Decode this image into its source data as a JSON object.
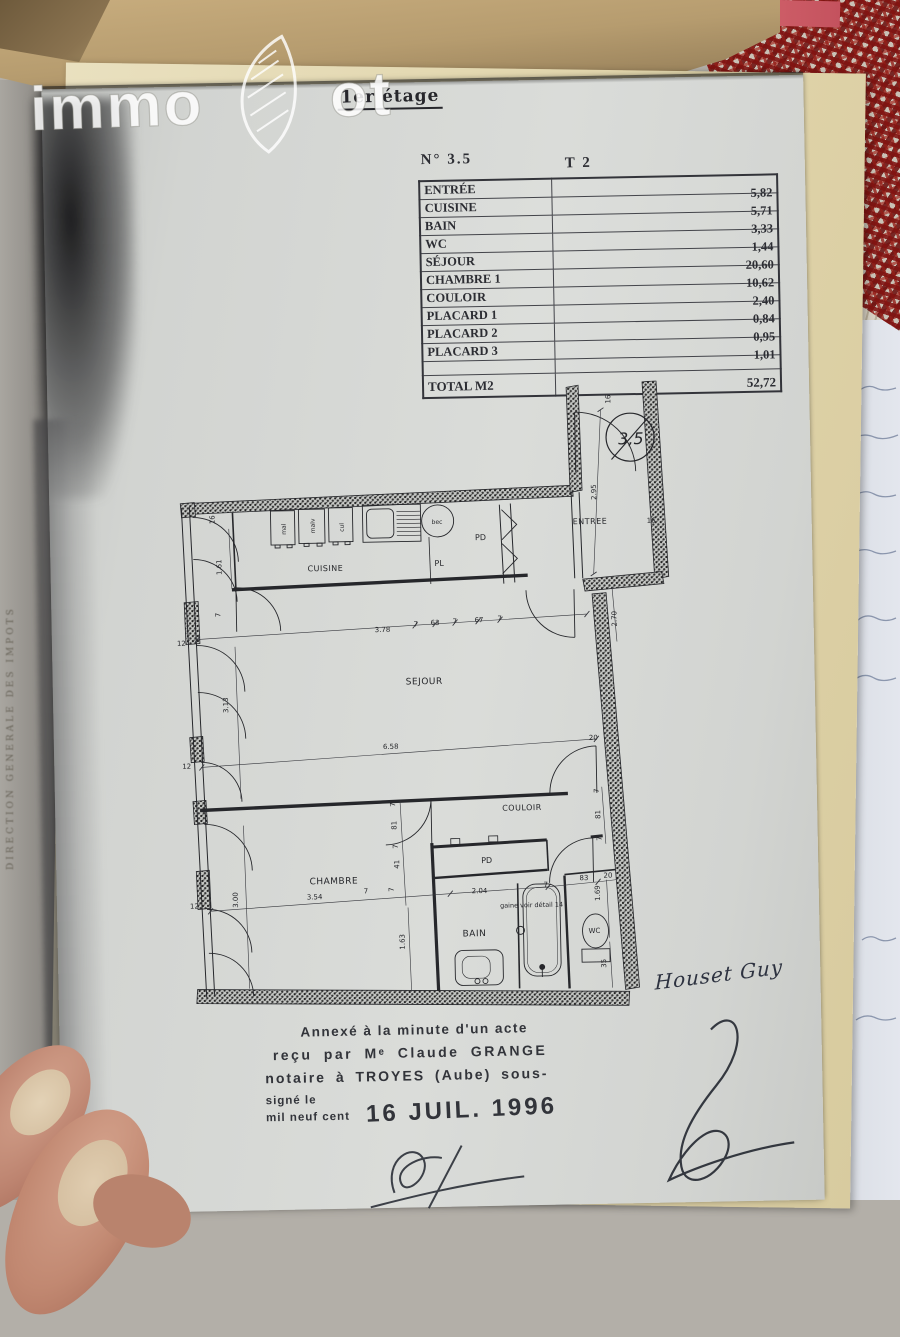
{
  "photo": {
    "watermark": {
      "part1": "immo",
      "part2": "ot"
    },
    "letterhead": "CLAUDE GRAN",
    "spine_text": "DIRECTION GENERALE DES IMPOTS"
  },
  "page": {
    "title": "1er étage",
    "doc_number": "N°  3.5",
    "type_label": "T 2",
    "table": {
      "rows": [
        {
          "label": "ENTRÉE",
          "value": "5,82"
        },
        {
          "label": "CUISINE",
          "value": "5,71"
        },
        {
          "label": "BAIN",
          "value": "3,33"
        },
        {
          "label": "WC",
          "value": "1,44"
        },
        {
          "label": "SÉJOUR",
          "value": "20,60"
        },
        {
          "label": "CHAMBRE 1",
          "value": "10,62"
        },
        {
          "label": "COULOIR",
          "value": "2,40"
        },
        {
          "label": "PLACARD 1",
          "value": "0,84"
        },
        {
          "label": "PLACARD 2",
          "value": "0,95"
        },
        {
          "label": "PLACARD 3",
          "value": "1,01"
        }
      ],
      "total_label": "TOTAL M2",
      "total_value": "52,72"
    },
    "annotation": {
      "line1": "Annexé à la minute d'un acte",
      "line2": "reçu par Mᵉ Claude GRANGE",
      "line3": "notaire à TROYES (Aube) sous-",
      "line4a": "signé le",
      "line4b": "mil neuf cent",
      "date_stamp": "16 JUIL. 1996"
    },
    "signature_name": "Houset Guy"
  },
  "plan": {
    "unit_circle": "3,5",
    "rooms": {
      "entree": "ENTREE",
      "cuisine": "CUISINE",
      "pl": "PL",
      "pd_kitchen": "PD",
      "sejour": "SEJOUR",
      "couloir": "COULOIR",
      "pd_couloir": "PD",
      "chambre": "CHAMBRE",
      "bain": "BAIN",
      "wc": "WC"
    },
    "fixtures": {
      "f1": "mal",
      "f2": "malv",
      "f3": "cul",
      "f4": "bec"
    },
    "note": "gaine voir détail 14",
    "dims": [
      "16",
      "2.95",
      "16",
      "2.70",
      "16",
      "1.61",
      "7",
      "12",
      "3.78",
      "7",
      "63",
      "7",
      "67",
      "7",
      "6.58",
      "20",
      "3.13",
      "12",
      "7",
      "81",
      "7",
      "41",
      "7",
      "7",
      "81",
      "7",
      "2.04",
      "7",
      "83",
      "20",
      "1.69",
      "35",
      "3.54",
      "3.00",
      "12",
      "1.63",
      "7"
    ]
  }
}
